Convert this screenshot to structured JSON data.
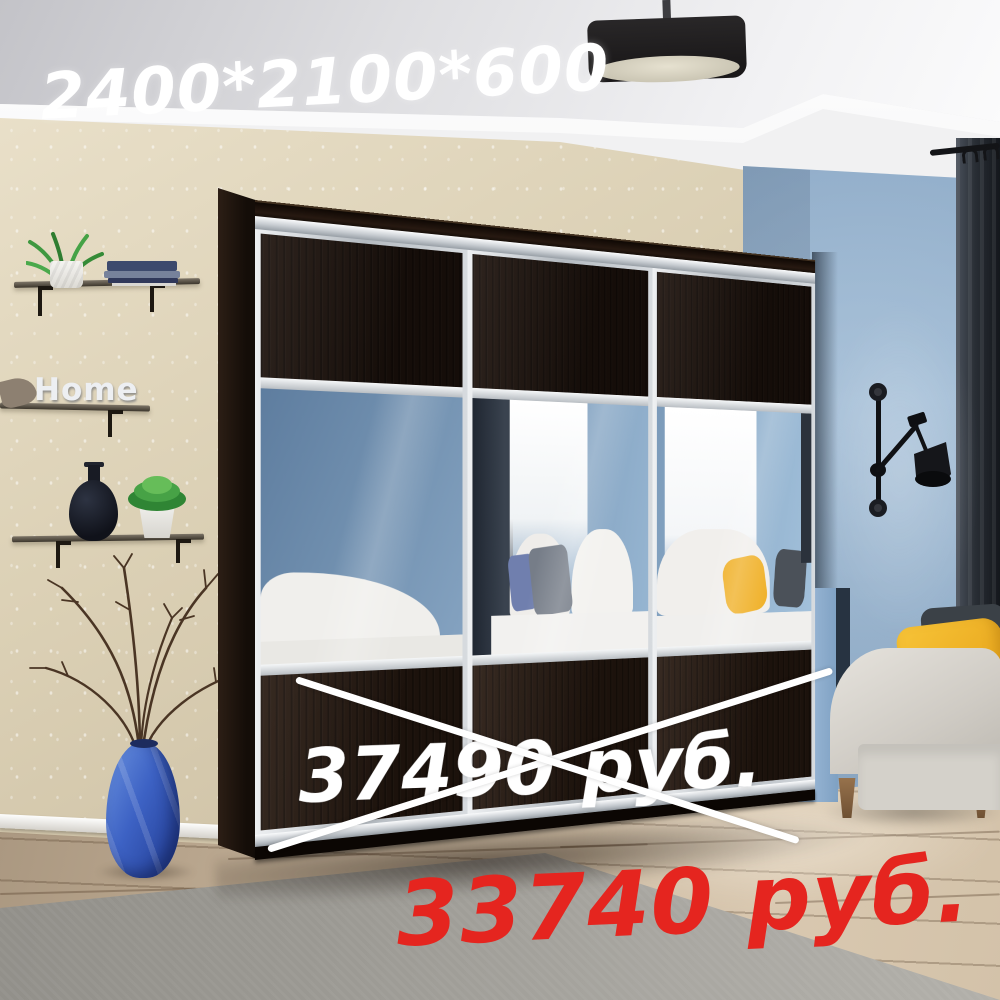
{
  "overlays": {
    "dimensions": "2400*2100*600",
    "old_price": "37490 руб.",
    "new_price": "33740 руб."
  },
  "decor": {
    "shelf_sign": "Home"
  },
  "colors": {
    "old_price_text": "#ffffff",
    "new_price_text": "#e5251f",
    "strike_cross": "#ffffff",
    "accent_wall_blue": "#88a7c6",
    "back_wall_beige": "#d5c9ae",
    "wardrobe_wenge": "#1e130d",
    "wardrobe_frame_aluminum": "#c7ccd1",
    "sofa_gray": "#d6d3cc",
    "pillow_yellow": "#f0b32a",
    "floor_vase_blue": "#3d62c4",
    "rug_gray": "#9a9892",
    "floor_wood": "#c7b59d"
  }
}
